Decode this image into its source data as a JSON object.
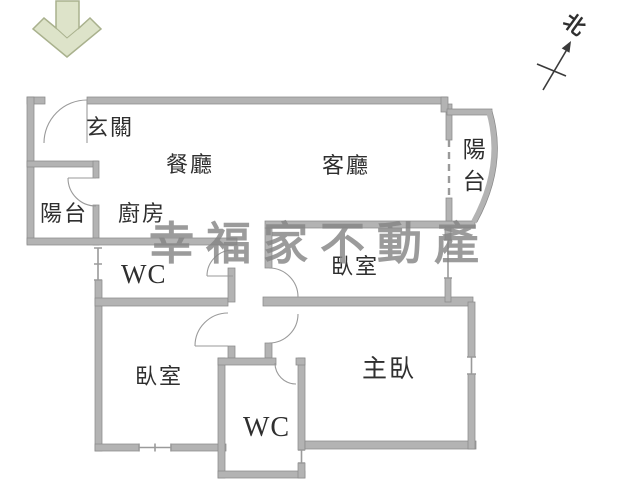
{
  "floor_plan": {
    "title": "apartment-floor-plan",
    "rooms": {
      "entry": "玄關",
      "dining": "餐廳",
      "living": "客廳",
      "kitchen": "廚房",
      "balcony_left": "陽台",
      "balcony_right": "陽台",
      "wc_top": "WC",
      "wc_bottom": "WC",
      "bedroom_upper": "臥室",
      "bedroom_lower": "臥室",
      "master_bedroom": "主臥"
    },
    "compass": {
      "north": "北"
    },
    "watermark": {
      "text": "幸福家不動產",
      "color": "#858585"
    },
    "entrance_arrow": {
      "meaning": "entrance-direction-down",
      "fill": "#dde3c9",
      "edge": "#a9b18d"
    },
    "colors": {
      "wall_fill": "#b3b3b3",
      "wall_edge": "#8a8a8a",
      "door_line": "#9a9a9a",
      "label_text": "#2f2f2f",
      "compass": "#3a3a3a"
    }
  }
}
